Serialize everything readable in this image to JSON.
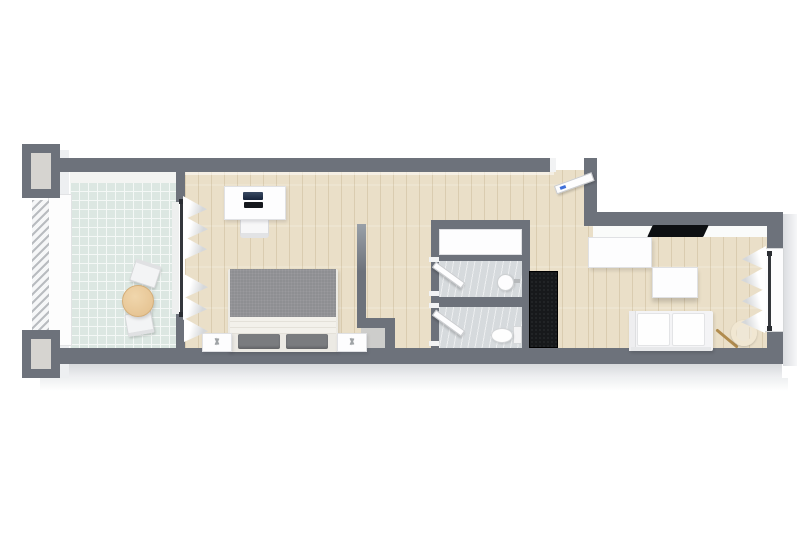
{
  "canvas": {
    "width": 800,
    "height": 533,
    "background": "#ffffff"
  },
  "scene": {
    "kind": "3d-floor-plan-render-top-view",
    "rooms": [
      "terrace",
      "bedroom",
      "hallway",
      "shower-room",
      "wc-room",
      "living-room"
    ],
    "furniture": [
      "terrace-round-table",
      "terrace-chair",
      "desk",
      "laptop",
      "desk-chair",
      "double-bed",
      "duvet",
      "pillows",
      "nightstand",
      "window-curtains",
      "shower-unit",
      "washbasin",
      "toilet",
      "dark-wardrobe",
      "entry-door",
      "interior-door",
      "tv",
      "sideboard",
      "coffee-table",
      "sofa",
      "floor-lamp",
      "balcony-railing",
      "chimney-pillar"
    ]
  },
  "colors": {
    "wall": "#6d727b",
    "wallLight": "#99a0a8",
    "wood": "#eadfc8",
    "tileTerrace": "#dce7e2",
    "grout": "#f4f8f6",
    "tileBath": "#d6dadd",
    "white": "#fdfdfe",
    "edge": "#e0e1e4",
    "duvet": "#8e8f92",
    "pillow": "#7a7c7f",
    "sheet": "#f3f1eb",
    "dark": "#17191b",
    "tv": "#0d0f12",
    "tableWood": "#e9c795",
    "glass": "#34373c",
    "lampRing": "#f1e7d2",
    "lampStem": "#b18c4e",
    "doorTag": "#3f6fd9",
    "pillarInner": "#d6d4d0",
    "niche": "#cdcdcb"
  }
}
